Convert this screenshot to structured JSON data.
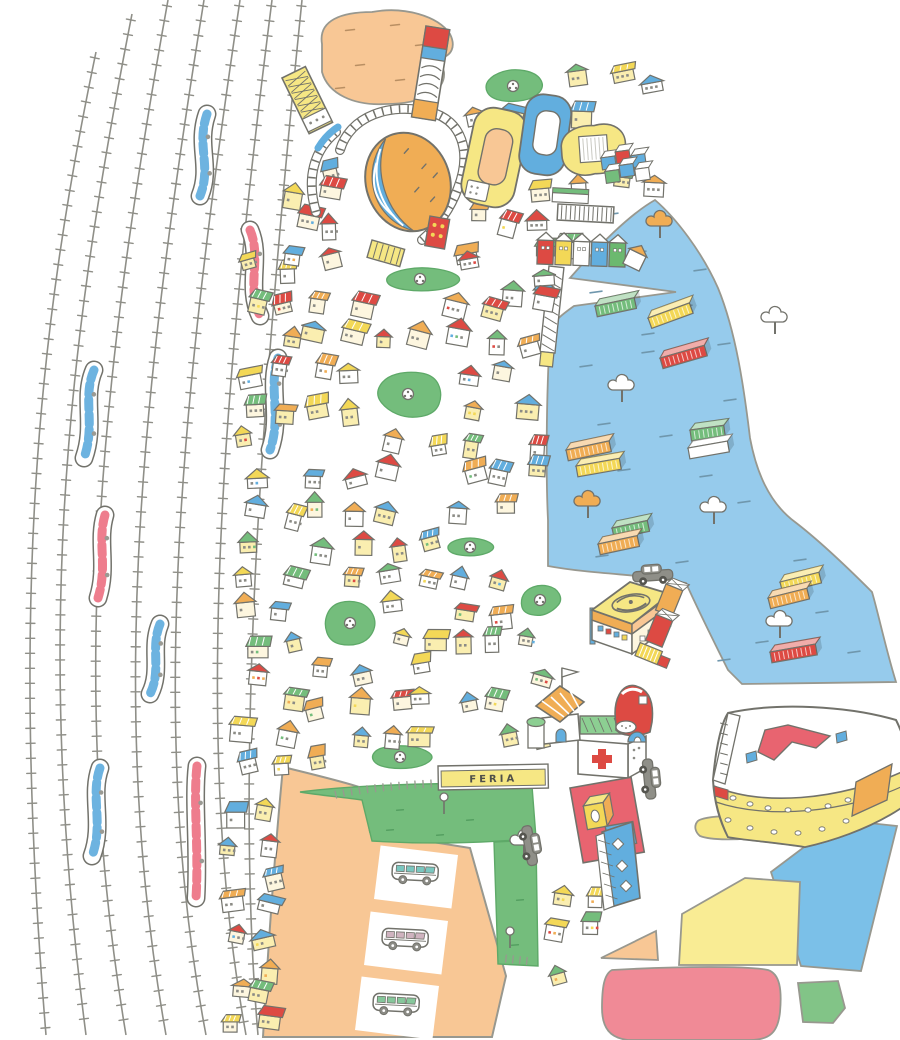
{
  "canvas": {
    "width": 900,
    "height": 1040,
    "background": "#ffffff"
  },
  "labels": {
    "feria": "FERIA"
  },
  "palette": {
    "outline": "#72726b",
    "soft": "#98988f",
    "yellow": "#f6e784",
    "yellow_deep": "#f3d857",
    "orange": "#f0ad55",
    "orange_pale": "#f8c795",
    "red": "#dd4a43",
    "pink": "#ef8796",
    "plaza_red": "#e86470",
    "blue": "#62aede",
    "water": "#96cbec",
    "sky": "#7bc0e8",
    "green": "#74bd7c",
    "green_pale": "#8ccf92",
    "white": "#ffffff",
    "gray": "#8b8b85",
    "body_yellow": "#faeeb0",
    "blob_red": "#f08a96"
  },
  "railyard": {
    "tie_gap": 15,
    "tie_len": 9,
    "tracks": [
      "M96,52 C38,330 10,600 46,1035",
      "M132,14 C62,370 36,650 86,1035",
      "M168,0 C96,400 70,700 126,1035",
      "M204,0 C136,420 110,720 166,1035",
      "M240,0 C176,430 150,740 206,1035",
      "M272,0 C216,440 196,760 246,1035",
      "M302,0 C256,450 236,780 258,1035"
    ],
    "trains": [
      {
        "color": "blue",
        "d": "M207,114 C196,146 212,166 200,196"
      },
      {
        "color": "pink",
        "d": "M250,230 C262,258 246,286 260,316"
      },
      {
        "color": "blue",
        "d": "M94,370 C82,398 96,424 84,458"
      },
      {
        "color": "blue",
        "d": "M278,358 C268,388 282,416 270,450"
      },
      {
        "color": "pink",
        "d": "M105,515 C97,542 108,566 98,598"
      },
      {
        "color": "blue",
        "d": "M160,624 C150,648 162,670 150,694"
      },
      {
        "color": "blue",
        "d": "M100,768 C90,796 104,824 92,856"
      },
      {
        "color": "pink",
        "d": "M197,766 C193,800 199,850 196,898"
      }
    ]
  },
  "harbor": {
    "water_path": "M655,200 C630,214 596,248 570,278 L676,292 L574,306 C560,316 552,322 550,334 C546,400 546,480 548,520 L548,566 C580,572 620,574 648,577 L686,583 C700,614 716,646 728,670 L742,684 C790,683 850,683 896,682 C886,650 878,612 872,592 C840,560 812,535 795,522 C768,502 756,470 750,438 C744,388 736,332 718,288 C702,252 676,218 655,200 Z",
    "pier": {
      "x": 549,
      "y": 266,
      "rot": 6
    },
    "containers": [
      [
        648,
        318,
        -20,
        "yellow_deep",
        44
      ],
      [
        595,
        306,
        -12,
        "green",
        40
      ],
      [
        660,
        358,
        -16,
        "red",
        46
      ],
      [
        566,
        450,
        -12,
        "orange",
        44
      ],
      [
        576,
        466,
        -10,
        "yellow_deep",
        44
      ],
      [
        690,
        430,
        -8,
        "green",
        34
      ],
      [
        688,
        448,
        -10,
        "white",
        40
      ],
      [
        612,
        528,
        -12,
        "green",
        36
      ],
      [
        598,
        544,
        -12,
        "orange",
        40
      ],
      [
        780,
        582,
        -14,
        "yellow_deep",
        40
      ],
      [
        768,
        598,
        -14,
        "orange",
        40
      ],
      [
        770,
        652,
        -10,
        "red",
        46
      ]
    ],
    "trees": [
      [
        660,
        222,
        "orange"
      ],
      [
        775,
        318,
        "white"
      ],
      [
        622,
        386,
        "white"
      ],
      [
        588,
        502,
        "orange"
      ],
      [
        714,
        508,
        "white"
      ],
      [
        780,
        622,
        "white"
      ]
    ],
    "ripples": [
      [
        612,
        214
      ],
      [
        640,
        252
      ],
      [
        700,
        270
      ],
      [
        596,
        292
      ],
      [
        686,
        306
      ],
      [
        724,
        344
      ],
      [
        648,
        352
      ],
      [
        604,
        424
      ],
      [
        666,
        436
      ],
      [
        706,
        476
      ],
      [
        624,
        470
      ],
      [
        744,
        502
      ],
      [
        602,
        556
      ],
      [
        682,
        562
      ],
      [
        762,
        642
      ],
      [
        724,
        660
      ],
      [
        822,
        612
      ],
      [
        854,
        652
      ],
      [
        586,
        366
      ],
      [
        648,
        334
      ],
      [
        730,
        400
      ],
      [
        800,
        560
      ]
    ]
  },
  "top_park": {
    "path": "M322,44 C318,20 342,12 372,12 C404,6 438,16 450,34 C456,46 452,56 440,58 L444,72 C446,92 420,104 386,104 C354,106 328,94 322,72 Z",
    "dashes": [
      [
        350,
        30
      ],
      [
        395,
        25
      ],
      [
        420,
        45
      ],
      [
        360,
        65
      ],
      [
        400,
        80
      ],
      [
        340,
        88
      ],
      [
        430,
        62
      ]
    ]
  },
  "parking": {
    "path": "M283,767 C320,776 348,783 362,788 L370,832 L470,848 L506,976 L492,1037 L263,1037 C268,950 274,860 283,767 Z",
    "slots": [
      {
        "cx": 416,
        "cy": 877
      },
      {
        "cx": 406,
        "cy": 943
      },
      {
        "cx": 397,
        "cy": 1008
      }
    ],
    "slot_rot": 7,
    "van_window_colors": [
      "#7bc7c0",
      "#cfb3bf",
      "#86c79b"
    ]
  },
  "esplanade": {
    "main_path": "M300,792 C360,784 480,781 532,786 L536,838 C480,844 420,844 372,841 L362,800 C340,797 318,795 300,792 Z",
    "strip_path": "M494,842 L536,840 L538,966 L498,964 Z",
    "tick_path": "M330,796 C360,788 420,783 470,782",
    "tick_path2": "M500,958 L536,962",
    "signs": [
      [
        444,
        800
      ],
      [
        510,
        934
      ]
    ],
    "trees": [
      [
        524,
        841,
        "white"
      ]
    ]
  },
  "zones": [
    {
      "name": "yellow-blob-zone",
      "color": "#f6e784",
      "path": "M697,822 C700,816 740,814 755,818 C766,820 768,830 762,836 C740,841 710,840 700,836 C695,832 694,826 697,822 Z"
    },
    {
      "name": "blue-band-zone",
      "color": "#7bc0e8",
      "path": "M840,820 L897,826 L861,971 L801,966 L771,872 Z"
    },
    {
      "name": "yellow-quad-zone",
      "color": "#f9ec94",
      "path": "M745,878 L800,882 L797,965 L679,965 L682,914 Z"
    },
    {
      "name": "orange-tri-zone",
      "color": "#f8c795",
      "path": "M601,958 L656,931 L658,960 Z"
    },
    {
      "name": "red-blob-zone",
      "color": "#f08a96",
      "path": "M612,970 C680,966 750,966 768,970 C780,974 782,990 780,1012 C778,1032 770,1040 750,1040 L628,1040 C610,1038 602,1028 602,1008 C602,988 604,974 612,970 Z"
    },
    {
      "name": "green-poly-zone",
      "color": "#82c487",
      "path": "M798,983 L838,981 L845,1008 L833,1023 L803,1022 Z"
    }
  ],
  "parks": [
    [
      513,
      86,
      30,
      17
    ],
    [
      420,
      279,
      40,
      12
    ],
    [
      408,
      394,
      34,
      25
    ],
    [
      350,
      623,
      25,
      24
    ],
    [
      470,
      547,
      25,
      9
    ],
    [
      400,
      757,
      31,
      13
    ],
    [
      540,
      600,
      21,
      16
    ]
  ],
  "city_blocks": [
    {
      "x": 452,
      "y": 58,
      "w": 215,
      "h": 245,
      "cols": 6,
      "rows": 7,
      "seed": 7,
      "avoid": [
        {
          "x": 575,
          "y": 205,
          "w": 130,
          "h": 100
        }
      ]
    },
    {
      "x": 232,
      "y": 250,
      "w": 322,
      "h": 308,
      "cols": 9,
      "rows": 9,
      "seed": 13,
      "avoid": []
    },
    {
      "x": 232,
      "y": 562,
      "w": 322,
      "h": 216,
      "cols": 9,
      "rows": 7,
      "seed": 29,
      "avoid": [
        {
          "x": 430,
          "y": 752,
          "w": 125,
          "h": 40
        }
      ]
    },
    {
      "x": 220,
      "y": 795,
      "w": 62,
      "h": 242,
      "cols": 2,
      "rows": 8,
      "seed": 41,
      "avoid": []
    },
    {
      "x": 284,
      "y": 148,
      "w": 72,
      "h": 118,
      "cols": 2,
      "rows": 4,
      "seed": 53,
      "avoid": []
    },
    {
      "x": 548,
      "y": 874,
      "w": 66,
      "h": 112,
      "cols": 2,
      "rows": 3,
      "seed": 67,
      "avoid": []
    }
  ],
  "vehicles": {
    "cars": [
      [
        632,
        566,
        -4
      ],
      [
        658,
        758,
        84
      ],
      [
        537,
        824,
        80
      ]
    ]
  },
  "landmarks": [
    {
      "name": "coaster-dome",
      "x": 0,
      "y": 0
    },
    {
      "name": "yellow-stadium",
      "x": 478,
      "y": 104
    },
    {
      "name": "blue-stadium",
      "x": 528,
      "y": 92
    },
    {
      "name": "yellow-arena",
      "x": 560,
      "y": 128
    },
    {
      "name": "container-stack-blue",
      "x": 600,
      "y": 152
    },
    {
      "name": "warehouse",
      "x": 558,
      "y": 204
    },
    {
      "name": "rowhouses",
      "x": 538,
      "y": 234
    },
    {
      "name": "hatched-hall",
      "x": 282,
      "y": 78
    },
    {
      "name": "striped-tower",
      "x": 426,
      "y": 26
    },
    {
      "name": "police-station",
      "x": 586,
      "y": 558
    },
    {
      "name": "dock-stack",
      "x": 666,
      "y": 584
    },
    {
      "name": "hospital",
      "x": 578,
      "y": 716
    },
    {
      "name": "church",
      "x": 536,
      "y": 684
    },
    {
      "name": "shoe-pavilion",
      "x": 612,
      "y": 680
    },
    {
      "name": "red-plaza",
      "x": 570,
      "y": 788
    },
    {
      "name": "trellis-tower",
      "x": 596,
      "y": 820
    },
    {
      "name": "ferry-boat",
      "x": 688,
      "y": 690
    }
  ],
  "feria_sign": {
    "x": 438,
    "y": 766,
    "w": 110,
    "h": 24
  }
}
